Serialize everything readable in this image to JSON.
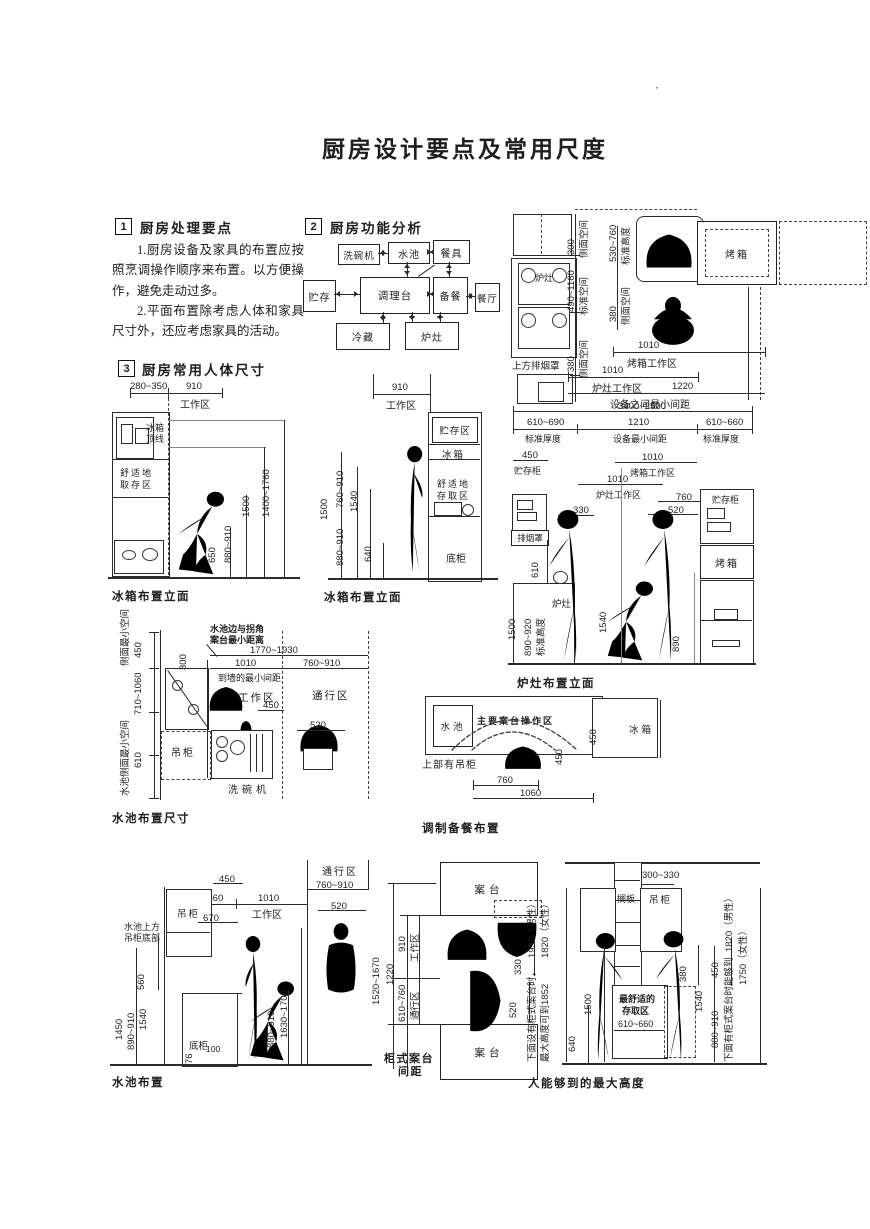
{
  "page": {
    "title": "厨房设计要点及常用尺度",
    "corner_mark": "·"
  },
  "section1": {
    "num": "1",
    "heading": "厨房处理要点",
    "para1": "1.厨房设备及家具的布置应按照烹调操作顺序来布置。以方便操作，避免走动过多。",
    "para2": "2.平面布置除考虑人体和家具尺寸外，还应考虑家具的活动。"
  },
  "section2": {
    "num": "2",
    "heading": "厨房功能分析",
    "boxes": {
      "dishwasher": "洗碗机",
      "sink": "水池",
      "tableware": "餐具",
      "storage": "贮存",
      "counter": "调理台",
      "prep": "备餐",
      "dining": "餐厅",
      "cold": "冷藏",
      "stove": "炉灶"
    }
  },
  "section3": {
    "num": "3",
    "heading": "厨房常用人体尺寸"
  },
  "stove_plan": {
    "hood_label": "上方排烟罩",
    "stove": "炉灶",
    "oven": "烤箱",
    "d300": "300",
    "side_space1": "侧面空间",
    "d490_1160": "490~1160",
    "std_space": "标准空间",
    "d380a": "380",
    "side_space2": "侧面空间",
    "d530_760": "530~760",
    "std_height": "标准高度",
    "d380b": "380",
    "side_space3": "侧面空间",
    "d1010_oven": "1010",
    "oven_zone": "烤箱工作区",
    "d1010_stove": "1010",
    "stove_zone": "炉灶工作区",
    "d1220": "1220",
    "min_gap": "设备之间最小间距"
  },
  "fridge1": {
    "caption": "冰箱布置立面",
    "d280_350": "280~350",
    "d910": "910",
    "work_zone": "工作区",
    "top_line1": "冰箱",
    "top_line2": "顶线",
    "comfort1": "舒适地",
    "comfort2": "取存区",
    "d650": "650",
    "d880_910": "880~910",
    "d1500": "1500",
    "d1400_1760": "1400~1760"
  },
  "fridge2": {
    "caption": "冰箱布置立面",
    "d910": "910",
    "work_zone": "工作区",
    "storage_zone": "贮存区",
    "fridge": "冰箱",
    "comfort1": "舒适地",
    "comfort2": "存取区",
    "base": "底柜",
    "d1500": "1500",
    "d760_910": "760~910",
    "d1540": "1540",
    "d880_910": "880~910",
    "d640": "640"
  },
  "stove_elev": {
    "caption": "炉灶布置立面",
    "d3400_2500": "3400~2500",
    "d610_690": "610~690",
    "std_thk1": "标准厚度",
    "d1210": "1210",
    "min_gap": "设备最小间距",
    "d610_660": "610~660",
    "std_thk2": "标准厚度",
    "d450": "450",
    "storage1": "贮存柜",
    "d1010_oven": "1010",
    "oven_zone": "烤箱工作区",
    "d1010_stove": "1010",
    "stove_zone": "炉灶工作区",
    "d330": "330",
    "d760": "760",
    "d520": "520",
    "hood": "排烟罩",
    "d610": "610",
    "d1500": "1500",
    "d890_920": "890~920",
    "std_height": "标准高度",
    "stove": "炉灶",
    "d1540": "1540",
    "d890": "890",
    "storage2": "贮存柜",
    "oven": "烤箱"
  },
  "sink_plan": {
    "caption": "水池布置尺寸",
    "note1": "水池边与拐角",
    "note2": "案台最小距离",
    "side_min": "侧面最小空间",
    "d450a": "450",
    "d300": "300",
    "d710_1060": "710~1060",
    "sink_side_min": "水池侧面最小空间",
    "d610": "610",
    "d1770_1930": "1770~1930",
    "d1010": "1010",
    "wall_min": "到墙的最小间距",
    "d760_910": "760~910",
    "work_zone": "工作区",
    "pass_zone": "通行区",
    "d450b": "450",
    "d520": "520",
    "cabinet": "吊柜",
    "dishwasher": "洗碗机"
  },
  "prep_plan": {
    "caption": "调制备餐布置",
    "sink": "水池",
    "main_zone": "主要案台操作区",
    "fridge": "冰箱",
    "upper_cab": "上部有吊柜",
    "d450a": "450",
    "d450b": "450",
    "d760": "760",
    "d1060": "1060"
  },
  "sink_elev": {
    "caption": "水池布置",
    "pass_zone": "通行区",
    "d760_910": "760~910",
    "d450": "450",
    "d610_660": "610~660",
    "d1010": "1010",
    "work_zone": "工作区",
    "cabinet": "吊柜",
    "d670": "670",
    "d520": "520",
    "above1": "水池上方",
    "above2": "吊柜底部",
    "d560": "560",
    "d1450": "1450",
    "d1540": "1540",
    "d890_910": "890~910",
    "sink": "水池",
    "base": "底柜",
    "d100": "100",
    "d76": "76",
    "d880_910": "880~910",
    "d1630_1700": "1630~1700"
  },
  "counter_plan": {
    "caption1": "柜式案台",
    "caption2": "间距",
    "counter_top": "案台",
    "counter_bottom": "案台",
    "d1520_1670": "1520~1670",
    "d1220": "1220",
    "d910": "910",
    "work_zone": "工作区",
    "d610_760": "610~760",
    "pass_zone": "通行区",
    "d330": "330",
    "d520": "520"
  },
  "reach": {
    "caption": "人能够到的最大高度",
    "d300_330": "300~330",
    "shelf": "搁板",
    "cabinet": "吊柜",
    "comfort1": "最舒适的",
    "comfort2": "存取区",
    "d610_660": "610~660",
    "d1500": "1500",
    "d640": "640",
    "d380": "380",
    "d450": "450",
    "d1540": "1540",
    "d880_910": "880~910",
    "left_note1": "下面设有柜式案台时，",
    "left_male": "1930（男性）",
    "left_note2": "最大高度可到1852",
    "left_female": "1820（女性）",
    "right_note": "下面有柜式案台时能够到",
    "right_male": "1820（男性）",
    "right_female": "1750（女性）"
  }
}
